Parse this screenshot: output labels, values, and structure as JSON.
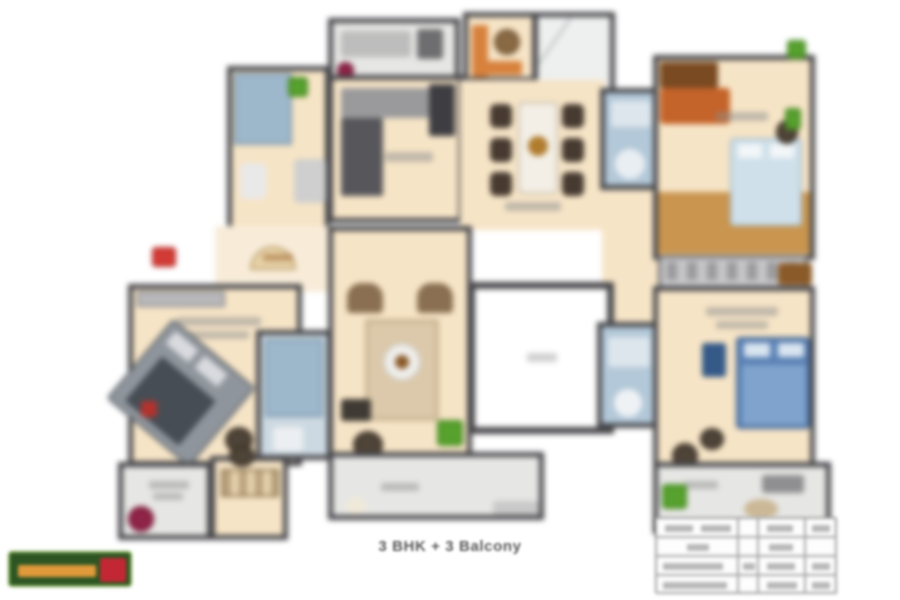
{
  "caption": {
    "text": "3 BHK + 3 Balcony"
  },
  "plan": {
    "type": "apartment-floor-plan",
    "regions": [
      "utility-balcony-top",
      "kitchen",
      "wash-area-marble",
      "dining-area",
      "bathroom-top-left",
      "bathroom-top-right",
      "bedroom-top-right",
      "foyer-corridor",
      "living-room",
      "lift-void",
      "bedroom-bottom-left",
      "bathroom-bottom-left",
      "bathroom-right",
      "bedroom-bottom-right",
      "dressing-area",
      "balcony-bottom-left",
      "balcony-living",
      "balcony-bottom-right"
    ],
    "icons": [
      "entrance-marker-icon",
      "plant-icon",
      "dining-table-icon",
      "bed-icon",
      "sofa-icon",
      "armchair-icon",
      "coffee-table-icon",
      "wardrobe-icon"
    ]
  },
  "colors": {
    "floor_tan": "#f6e4c6",
    "wall_dark": "#47474b",
    "balcony_gray": "#e6e6e4",
    "bath_blue": "#b3c8d8",
    "wood_brown": "#c9954f",
    "bed_blue": "#5b82b5",
    "sofa_orange": "#c4632a",
    "plant_green": "#57a12e",
    "plant_maroon": "#8e2448",
    "entrance_red": "#d23a35",
    "logo_green": "#2c5523",
    "logo_orange": "#e09a3a",
    "logo_red": "#c32733"
  },
  "area_table": {
    "note": "",
    "rows": 4,
    "columns": 4
  }
}
